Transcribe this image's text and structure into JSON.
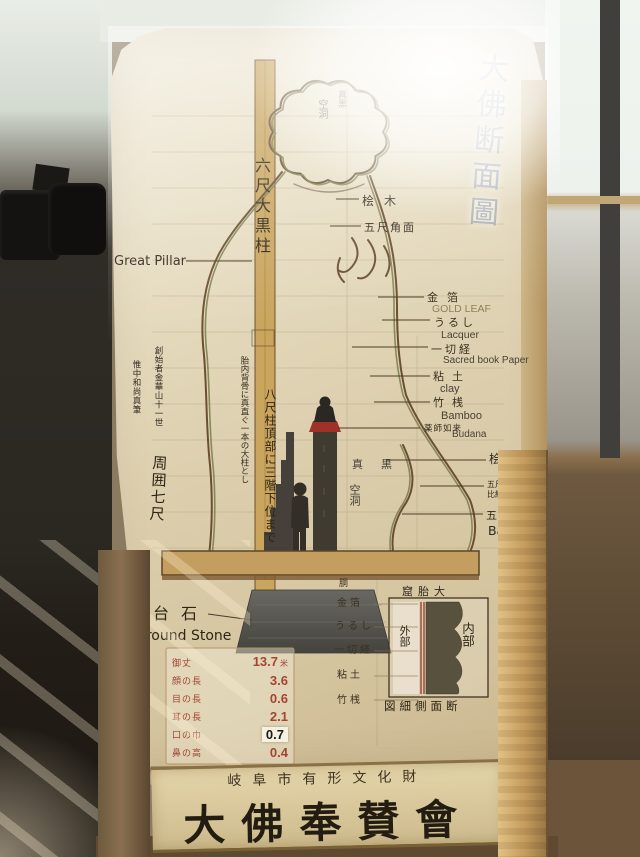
{
  "palette": {
    "board_cream": "#ddd2b8",
    "panel_tan": "#d9c79c",
    "pillar_tan": "#c9a55e",
    "contour_brown": "#6b4f33",
    "contour_olive": "#7e8050",
    "ink_dark": "#3a3026",
    "red_measure": "#a03a2a",
    "lotus_red": "#a5322a",
    "stone_gray": "#55534e",
    "frame_wood": "#c9a86a",
    "window_light": "#eef2ee"
  },
  "diagram": {
    "title_vertical": "大佛断面圖",
    "great_pillar": {
      "jp": "六尺大黒柱",
      "en": "Great Pillar"
    },
    "pillar_notes": {
      "side": "胎内背骨に真直ぐ一本の大柱とし",
      "main": "八尺柱頂部に三階下位まで"
    },
    "founder_note": {
      "col1": "創始者金華山十一世",
      "col2": "惟中和尚真筆"
    },
    "circumference": "周囲七尺",
    "head_cavity": {
      "dark": "真黒",
      "hollow": "空洞"
    },
    "chest_cavity": {
      "dark": "真黒",
      "hollow": "空洞"
    },
    "upper_right": {
      "wood": "桧木",
      "square": "五尺角面"
    },
    "materials": [
      {
        "jp": "金箔",
        "en": "GOLD LEAF"
      },
      {
        "jp": "うるし",
        "en": "Lacquer"
      },
      {
        "jp": "一切経",
        "en": "Sacred book Paper"
      },
      {
        "jp": "粘土",
        "en": "clay"
      },
      {
        "jp": "竹桟",
        "en": "Bamboo"
      },
      {
        "jp": "薬師如来",
        "en": "Budana"
      }
    ],
    "lower_right": {
      "wood": "桧木",
      "spec1": "五尺角長",
      "spec2": "比経参照",
      "square": "五尺角面",
      "en": "Bamboo"
    },
    "ground_stone": {
      "jp": "台石",
      "en": "Ground Stone"
    },
    "measurements": {
      "unit_first": "米",
      "rows": [
        {
          "label": "御丈",
          "value": "13.7"
        },
        {
          "label": "顔の長",
          "value": "3.6"
        },
        {
          "label": "目の長",
          "value": "0.6"
        },
        {
          "label": "耳の長",
          "value": "2.1"
        },
        {
          "label": "口の巾",
          "value": "0.7"
        },
        {
          "label": "鼻の高",
          "value": "0.4"
        }
      ]
    },
    "detail_box": {
      "title_rtl": "窟胎大",
      "outer": "外部",
      "inner": "内部",
      "caption_rtl": "図細側面断",
      "layers_header": "胴",
      "layers": [
        "金箔",
        "うるし",
        "一切経",
        "粘土",
        "竹桟"
      ]
    }
  },
  "panel": {
    "line_small": "岐阜市有形文化財",
    "line_large": "大佛奉賛會"
  }
}
